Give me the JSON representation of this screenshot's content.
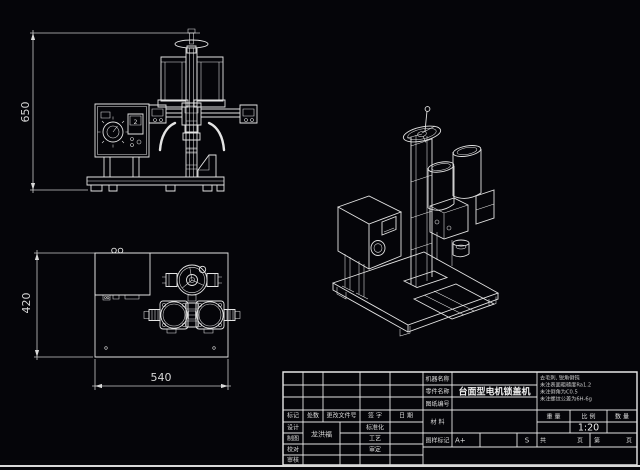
{
  "sheet": {
    "background": "#050509",
    "line_color": "#e4e4e4",
    "text_color": "#dedede"
  },
  "dimensions": {
    "front_height": "650",
    "plan_depth": "420",
    "plan_width": "540"
  },
  "front_view": {
    "display_value": "2"
  },
  "title_block": {
    "part_name_value": "台面型电机锁盖机",
    "labels": {
      "machine_name": "机器名称",
      "part_name": "零件名称",
      "drawing_no": "图纸编号",
      "material": "材  料",
      "stamp": "图样标记",
      "weight": "重 量",
      "scale": "比 例",
      "quantity": "数 量",
      "mark": "标记",
      "count": "处数",
      "change_doc": "更改文件号",
      "signature": "签 字",
      "date": "日 期",
      "design": "设计",
      "draft": "制图",
      "check": "校对",
      "review": "审核",
      "standardize": "标准化",
      "process": "工艺",
      "approve": "审定",
      "total": "共",
      "page1": "页",
      "ordinal": "第",
      "page2": "页"
    },
    "values": {
      "designer": "龙洪福",
      "scale": "1:20",
      "stamp_a": "A+",
      "stamp_s": "S"
    },
    "notes": [
      "去毛刺, 锐角倒钝",
      "未注表面粗糙度Ra1.2",
      "未注倒角为C0.5",
      "未注螺纹公差为6H-6g"
    ]
  }
}
